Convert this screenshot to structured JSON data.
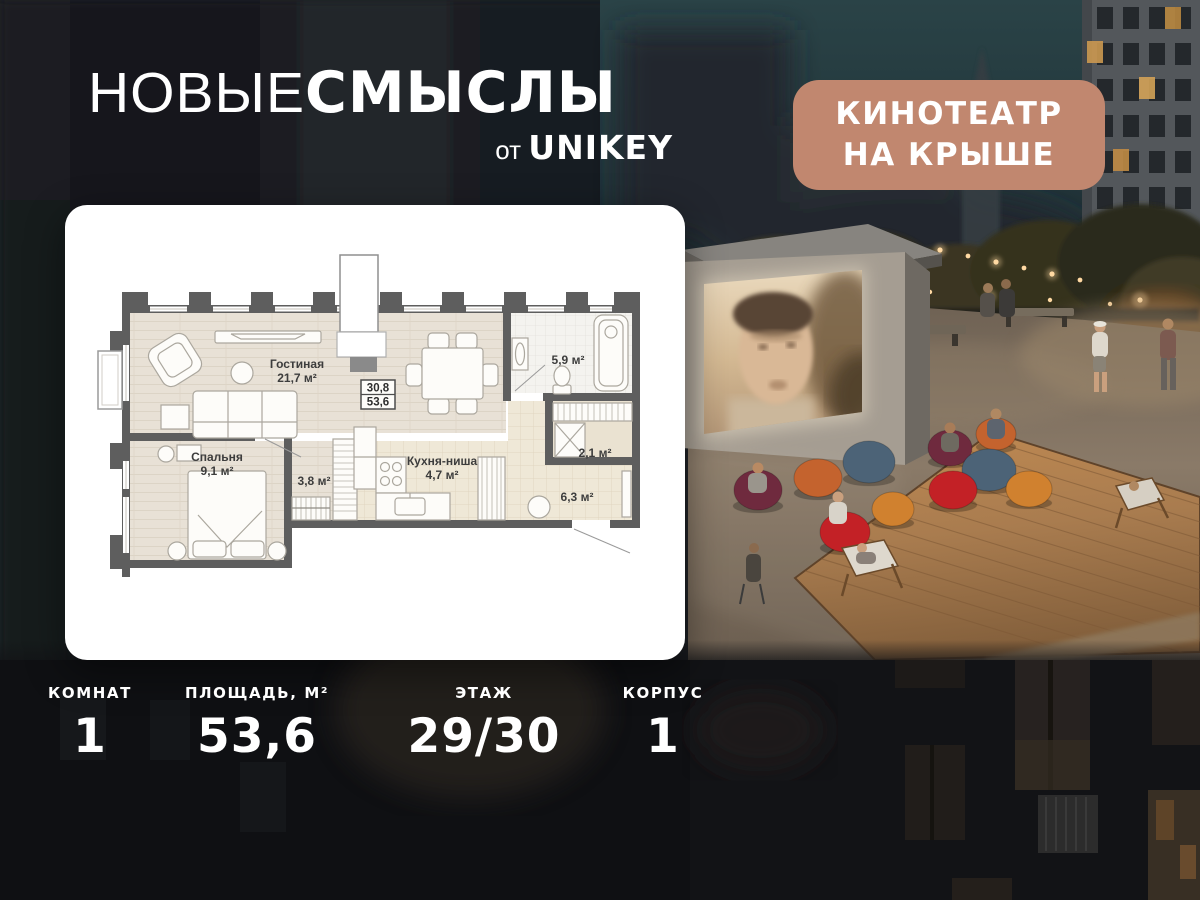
{
  "brand": {
    "title_light": "НОВЫЕ",
    "title_bold": "СМЫСЛЫ",
    "subtitle_prefix": "от ",
    "subtitle_brand": "UNIKEY"
  },
  "badge": {
    "line1": "КИНОТЕАТР",
    "line2": "НА КРЫШЕ",
    "bg_color": "#c1876f"
  },
  "floorplan": {
    "area_box": {
      "living_total": "30,8",
      "total": "53,6"
    },
    "rooms": {
      "living": {
        "name": "Гостиная",
        "area": "21,7 м²"
      },
      "bedroom": {
        "name": "Спальня",
        "area": "9,1 м²"
      },
      "corridor": {
        "area": "3,8 м²"
      },
      "kitchen": {
        "name": "Кухня-ниша",
        "area": "4,7 м²"
      },
      "bathroom": {
        "area": "5,9 м²"
      },
      "wardrobe": {
        "area": "2,1 м²"
      },
      "hall": {
        "area": "6,3 м²"
      }
    }
  },
  "stats": {
    "rooms": {
      "label": "КОМНАТ",
      "value": "1"
    },
    "area": {
      "label": "ПЛОЩАДЬ, М²",
      "value": "53,6"
    },
    "floor": {
      "label": "ЭТАЖ",
      "value": "29/30"
    },
    "building": {
      "label": "КОРПУС",
      "value": "1"
    }
  },
  "colors": {
    "badge_bg": "#c1876f",
    "wall": "#5e5e5e",
    "wood_floor": "#e8e1d6",
    "tile_floor": "#efe8d7",
    "beanbag_maroon": "#6f2a3e",
    "beanbag_red": "#c32126",
    "beanbag_orange": "#c4632e",
    "beanbag_amber": "#d0812f",
    "beanbag_blue": "#4c6377",
    "deck_wood": "#a97c4f",
    "string_light": "#ffd9a3"
  }
}
